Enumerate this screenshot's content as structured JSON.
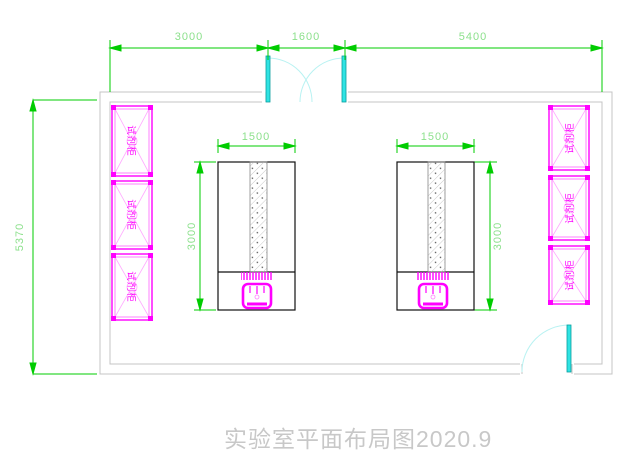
{
  "drawing": {
    "title": "实验室平面布局图2020.9",
    "dimensions": {
      "top": [
        "3000",
        "1600",
        "5400"
      ],
      "overall_height": "5370",
      "bench_left_width": "1500",
      "bench_right_width": "1500",
      "bench_left_depth": "3000",
      "bench_right_depth": "3000"
    },
    "cabinets": {
      "left": [
        "试剂柜",
        "试剂柜",
        "试剂柜"
      ],
      "right": [
        "试剂柜",
        "试剂柜",
        "试剂柜"
      ]
    },
    "doors": {
      "top_double_door": "double-swing-door",
      "bottom_right_door": "single-swing-door"
    },
    "colors": {
      "dimension_green": "#00cc00",
      "dimension_text_green": "#8ce08c",
      "cabinet_magenta": "#ff00ff",
      "cabinet_pink": "#ffaaff",
      "door_cyan": "#2fe3e3",
      "door_arc_cyan": "#b8f2f2",
      "wall_gray": "#c4c4c4",
      "bench_black": "#111111",
      "title_gray": "#c8c8c8"
    }
  }
}
